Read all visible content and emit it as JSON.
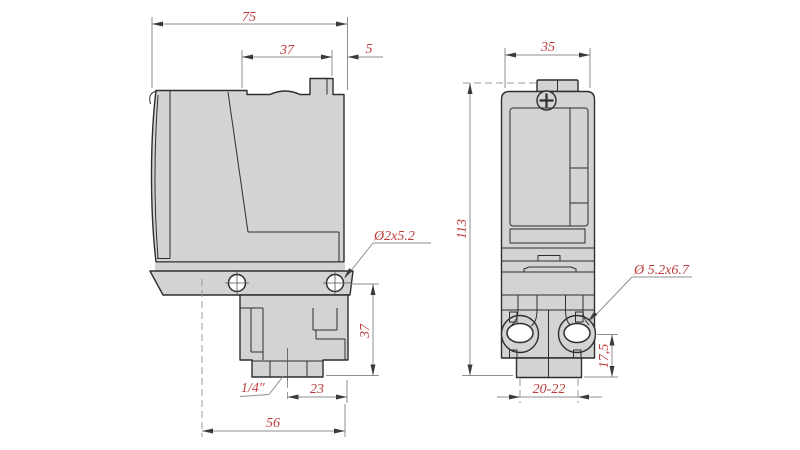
{
  "drawing": {
    "type": "technical-dimension-drawing",
    "subject": "pressure-switch two-view drawing",
    "colors": {
      "background": "#ffffff",
      "part_fill": "#d3d3d3",
      "part_outline": "#2e2e2e",
      "dimension_lines": "#8f8f8f",
      "dimension_text": "#bf3a3a"
    },
    "side_view": {
      "name": "side view (left)",
      "dims": {
        "overall_width": "75",
        "upper_width": "37",
        "top_offset": "5",
        "mount_hole_note": "Ø2x5.2",
        "lower_height": "37",
        "port_thread": "1/4″",
        "port_to_edge": "23",
        "base_width": "56"
      }
    },
    "front_view": {
      "name": "front view (right)",
      "dims": {
        "overall_width": "35",
        "overall_height": "113",
        "slot_note": "Ø 5.2x6.7",
        "slot_to_bottom": "17,5",
        "hole_spacing": "20-22"
      }
    }
  }
}
